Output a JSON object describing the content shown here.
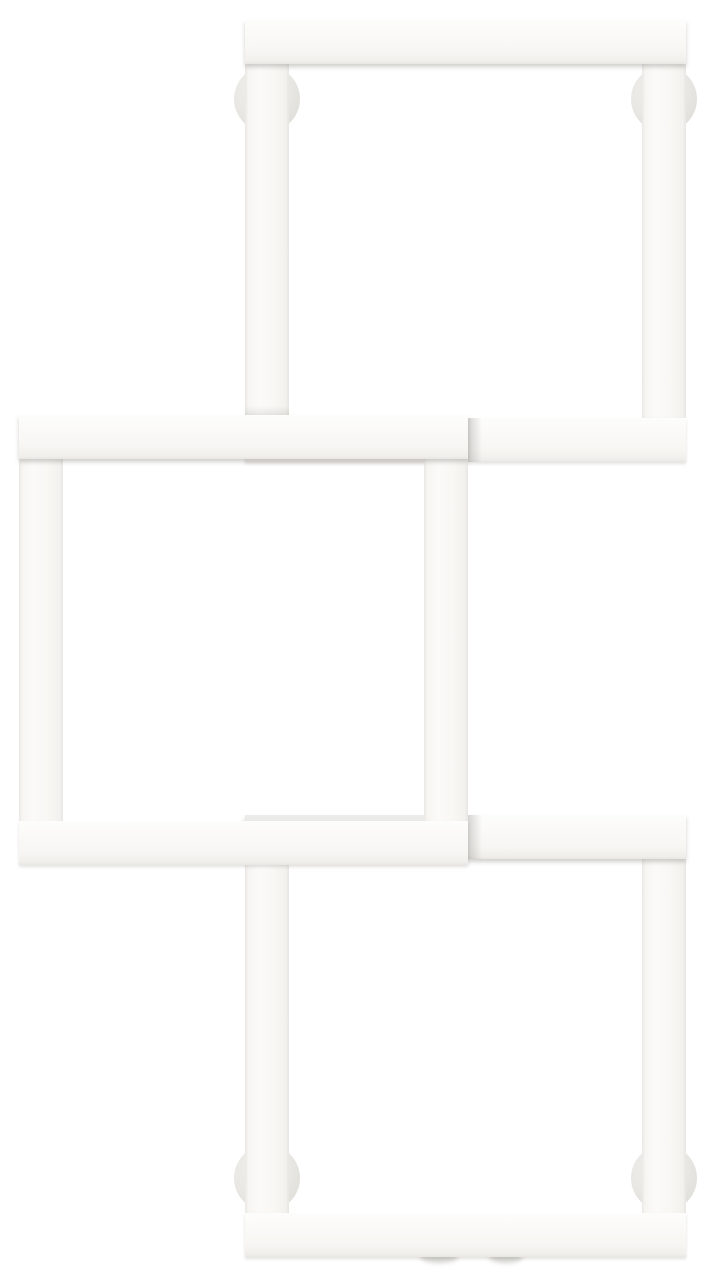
{
  "product": {
    "name": "three-square-white-wall-radiator",
    "background_color": "#ffffff",
    "frame_base_color": "#f9f8f5",
    "frame_edge_color": "#e9e7e3",
    "bracket_color": "#e7e6e2",
    "inner_shadow_color": "rgba(105,102,95,0.30)",
    "bar_thickness": 44,
    "squares": [
      {
        "id": "top-square",
        "x": 245,
        "y": 20,
        "width": 441,
        "height": 442,
        "z": 2
      },
      {
        "id": "bottom-square",
        "x": 245,
        "y": 815,
        "width": 441,
        "height": 442,
        "z": 2
      },
      {
        "id": "middle-square",
        "x": 19,
        "y": 415,
        "width": 449,
        "height": 450,
        "z": 3
      }
    ],
    "brackets": [
      {
        "id": "wall-bracket-top-left",
        "cx": 267,
        "cy": 99,
        "r": 33
      },
      {
        "id": "wall-bracket-top-right",
        "cx": 664,
        "cy": 99,
        "r": 33
      },
      {
        "id": "wall-bracket-bottom-left",
        "cx": 267,
        "cy": 1178,
        "r": 33
      },
      {
        "id": "wall-bracket-bottom-right",
        "cx": 664,
        "cy": 1178,
        "r": 33
      }
    ],
    "contact_shadows": [
      {
        "id": "crossing-shadow-upper",
        "x": 468,
        "y": 418,
        "width": 14,
        "height": 44,
        "style": "fade-right",
        "color": "rgba(105,102,95,0.26)"
      },
      {
        "id": "crossing-shadow-lower",
        "x": 468,
        "y": 815,
        "width": 14,
        "height": 44,
        "style": "fade-right",
        "color": "rgba(105,102,95,0.26)"
      },
      {
        "id": "occlusion-sliver-bottom-square",
        "x": 245,
        "y": 815,
        "width": 179,
        "height": 6,
        "style": "flat",
        "color": "rgba(125,122,115,0.13)"
      },
      {
        "id": "occlusion-above-middle-top-bar",
        "x": 245,
        "y": 406,
        "width": 44,
        "height": 9,
        "style": "fade-up",
        "color": "rgba(125,122,115,0.16)"
      }
    ],
    "floor_smudges": [
      {
        "id": "pipe-shadow-left",
        "x": 420,
        "y": 1250,
        "width": 38,
        "height": 13
      },
      {
        "id": "pipe-shadow-right",
        "x": 489,
        "y": 1250,
        "width": 34,
        "height": 13
      }
    ]
  }
}
